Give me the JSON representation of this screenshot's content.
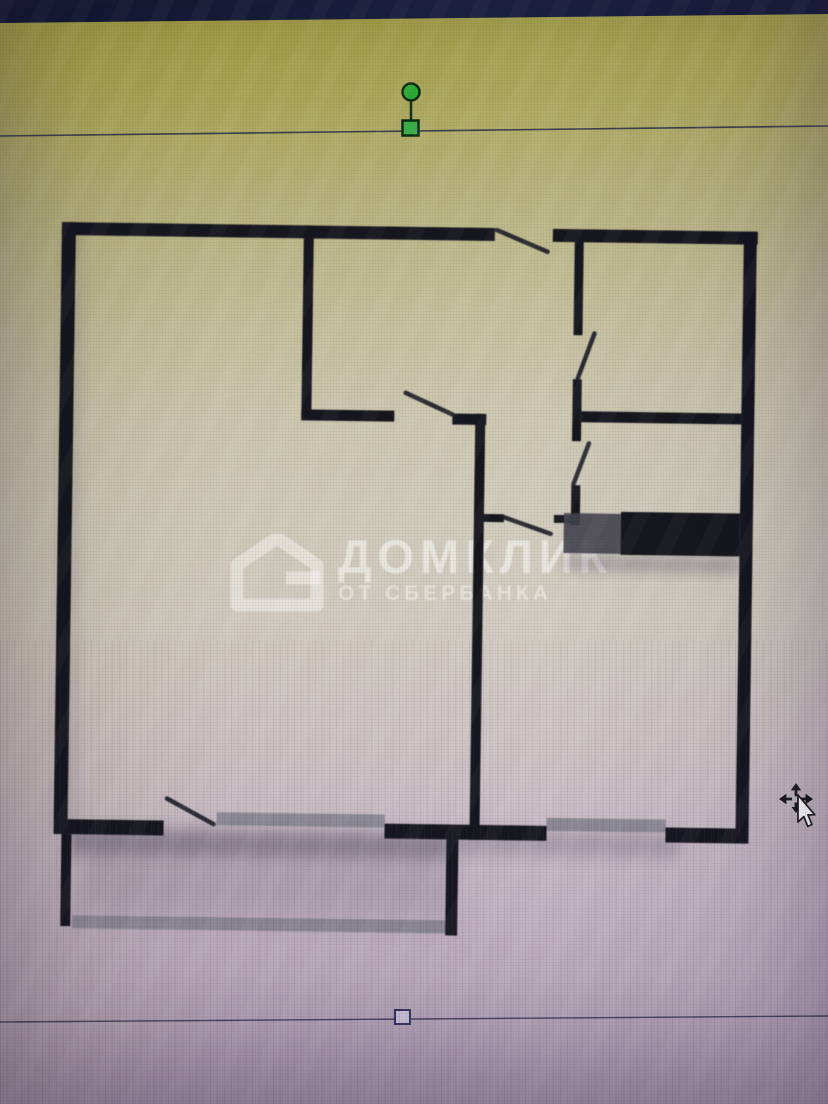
{
  "screen": {
    "top_bar_color": "#161b38",
    "background_top_color": "#a9a33f",
    "background_middle_color": "#d0cab9",
    "background_bottom_color": "#a391a8"
  },
  "watermark": {
    "title": "ДОМКЛИК",
    "subtitle": "ОТ СБЕРБАНКА",
    "logo": "domclick-house-logo",
    "color": "rgba(255,255,255,0.5)"
  },
  "selection": {
    "line_color": "#2a2a45",
    "handle_green": "#33b040",
    "top_line": {
      "x1": 0,
      "y1": 136,
      "x2": 828,
      "y2": 126
    },
    "bottom_line": {
      "x1": 0,
      "y1": 1022,
      "x2": 828,
      "y2": 1016
    },
    "stem": {
      "x1": 411,
      "y1": 101,
      "x2": 411,
      "y2": 122
    },
    "rotation_handle": {
      "cx": 411,
      "cy": 92,
      "r": 8.5,
      "fill": "#2caf38",
      "stroke": "#0f2d12"
    },
    "top_handle": {
      "x": 402.5,
      "y": 120.5,
      "w": 16,
      "h": 15,
      "fill": "#3db04a",
      "stroke": "#0f2d12"
    },
    "bottom_handle": {
      "x": 395,
      "y": 1010,
      "w": 15,
      "h": 14,
      "fill": "#c9bdd6",
      "stroke": "#31315e"
    }
  },
  "cursor": {
    "type": "move",
    "x": 776,
    "y": 782
  },
  "plan": {
    "wall_color": "#16161f",
    "window_color": "#7d7d88",
    "door_color": "#1c1c26",
    "rotation_deg": 0.8,
    "rotation_origin": [
      62,
      222
    ],
    "shadows": [
      {
        "x": 78,
        "y": 828,
        "w": 382,
        "h": 26,
        "fill": "#3c3650",
        "opacity": 0.38,
        "blur": 7
      },
      {
        "x": 92,
        "y": 842,
        "w": 368,
        "h": 72,
        "fill": "#6a6076",
        "opacity": 0.22,
        "blur": 14
      },
      {
        "x": 460,
        "y": 826,
        "w": 230,
        "h": 22,
        "fill": "#46405a",
        "opacity": 0.25,
        "blur": 8
      },
      {
        "x": 570,
        "y": 548,
        "w": 175,
        "h": 16,
        "fill": "#46405a",
        "opacity": 0.3,
        "blur": 6
      },
      {
        "x": 66,
        "y": 230,
        "w": 16,
        "h": 600,
        "fill": "#55506a",
        "opacity": 0.16,
        "blur": 8
      }
    ],
    "windows": [
      {
        "x": 225,
        "y": 810,
        "w": 168,
        "h": 13
      },
      {
        "x": 555,
        "y": 811,
        "w": 119,
        "h": 13
      },
      {
        "x": 82,
        "y": 915,
        "w": 376,
        "h": 13
      }
    ],
    "walls": [
      {
        "x": 62,
        "y": 222,
        "w": 433,
        "h": 13
      },
      {
        "x": 553,
        "y": 222,
        "w": 205,
        "h": 13
      },
      {
        "x": 62,
        "y": 222,
        "w": 14,
        "h": 612
      },
      {
        "x": 744,
        "y": 222,
        "w": 13,
        "h": 612
      },
      {
        "x": 72,
        "y": 819,
        "w": 100,
        "h": 15
      },
      {
        "x": 393,
        "y": 819,
        "w": 162,
        "h": 15
      },
      {
        "x": 674,
        "y": 819,
        "w": 80,
        "h": 15
      },
      {
        "x": 304,
        "y": 222,
        "w": 10,
        "h": 192
      },
      {
        "x": 304,
        "y": 406,
        "w": 93,
        "h": 11
      },
      {
        "x": 455,
        "y": 408,
        "w": 34,
        "h": 11
      },
      {
        "x": 478,
        "y": 408,
        "w": 10,
        "h": 426
      },
      {
        "x": 575,
        "y": 226,
        "w": 9,
        "h": 102
      },
      {
        "x": 575,
        "y": 372,
        "w": 9,
        "h": 62
      },
      {
        "x": 575,
        "y": 478,
        "w": 9,
        "h": 40
      },
      {
        "x": 584,
        "y": 404,
        "w": 160,
        "h": 11
      },
      {
        "x": 487,
        "y": 508,
        "w": 21,
        "h": 8
      },
      {
        "x": 558,
        "y": 508,
        "w": 17,
        "h": 8
      },
      {
        "x": 455,
        "y": 834,
        "w": 12,
        "h": 96
      },
      {
        "x": 70,
        "y": 834,
        "w": 10,
        "h": 92
      }
    ],
    "thick_blocks": [
      {
        "x": 568,
        "y": 506,
        "w": 57,
        "h": 40,
        "fill": "#42424e",
        "opacity": 0.9
      },
      {
        "x": 625,
        "y": 504,
        "w": 119,
        "h": 43,
        "fill": "#16161f",
        "opacity": 1
      }
    ],
    "doors": [
      {
        "x1": 497,
        "y1": 224,
        "x2": 548,
        "y2": 245
      },
      {
        "x1": 408,
        "y1": 388,
        "x2": 455,
        "y2": 409
      },
      {
        "x1": 596,
        "y1": 326,
        "x2": 580,
        "y2": 371
      },
      {
        "x1": 592,
        "y1": 436,
        "x2": 577,
        "y2": 477
      },
      {
        "x1": 508,
        "y1": 511,
        "x2": 555,
        "y2": 527
      },
      {
        "x1": 175,
        "y1": 797,
        "x2": 222,
        "y2": 822
      }
    ]
  }
}
